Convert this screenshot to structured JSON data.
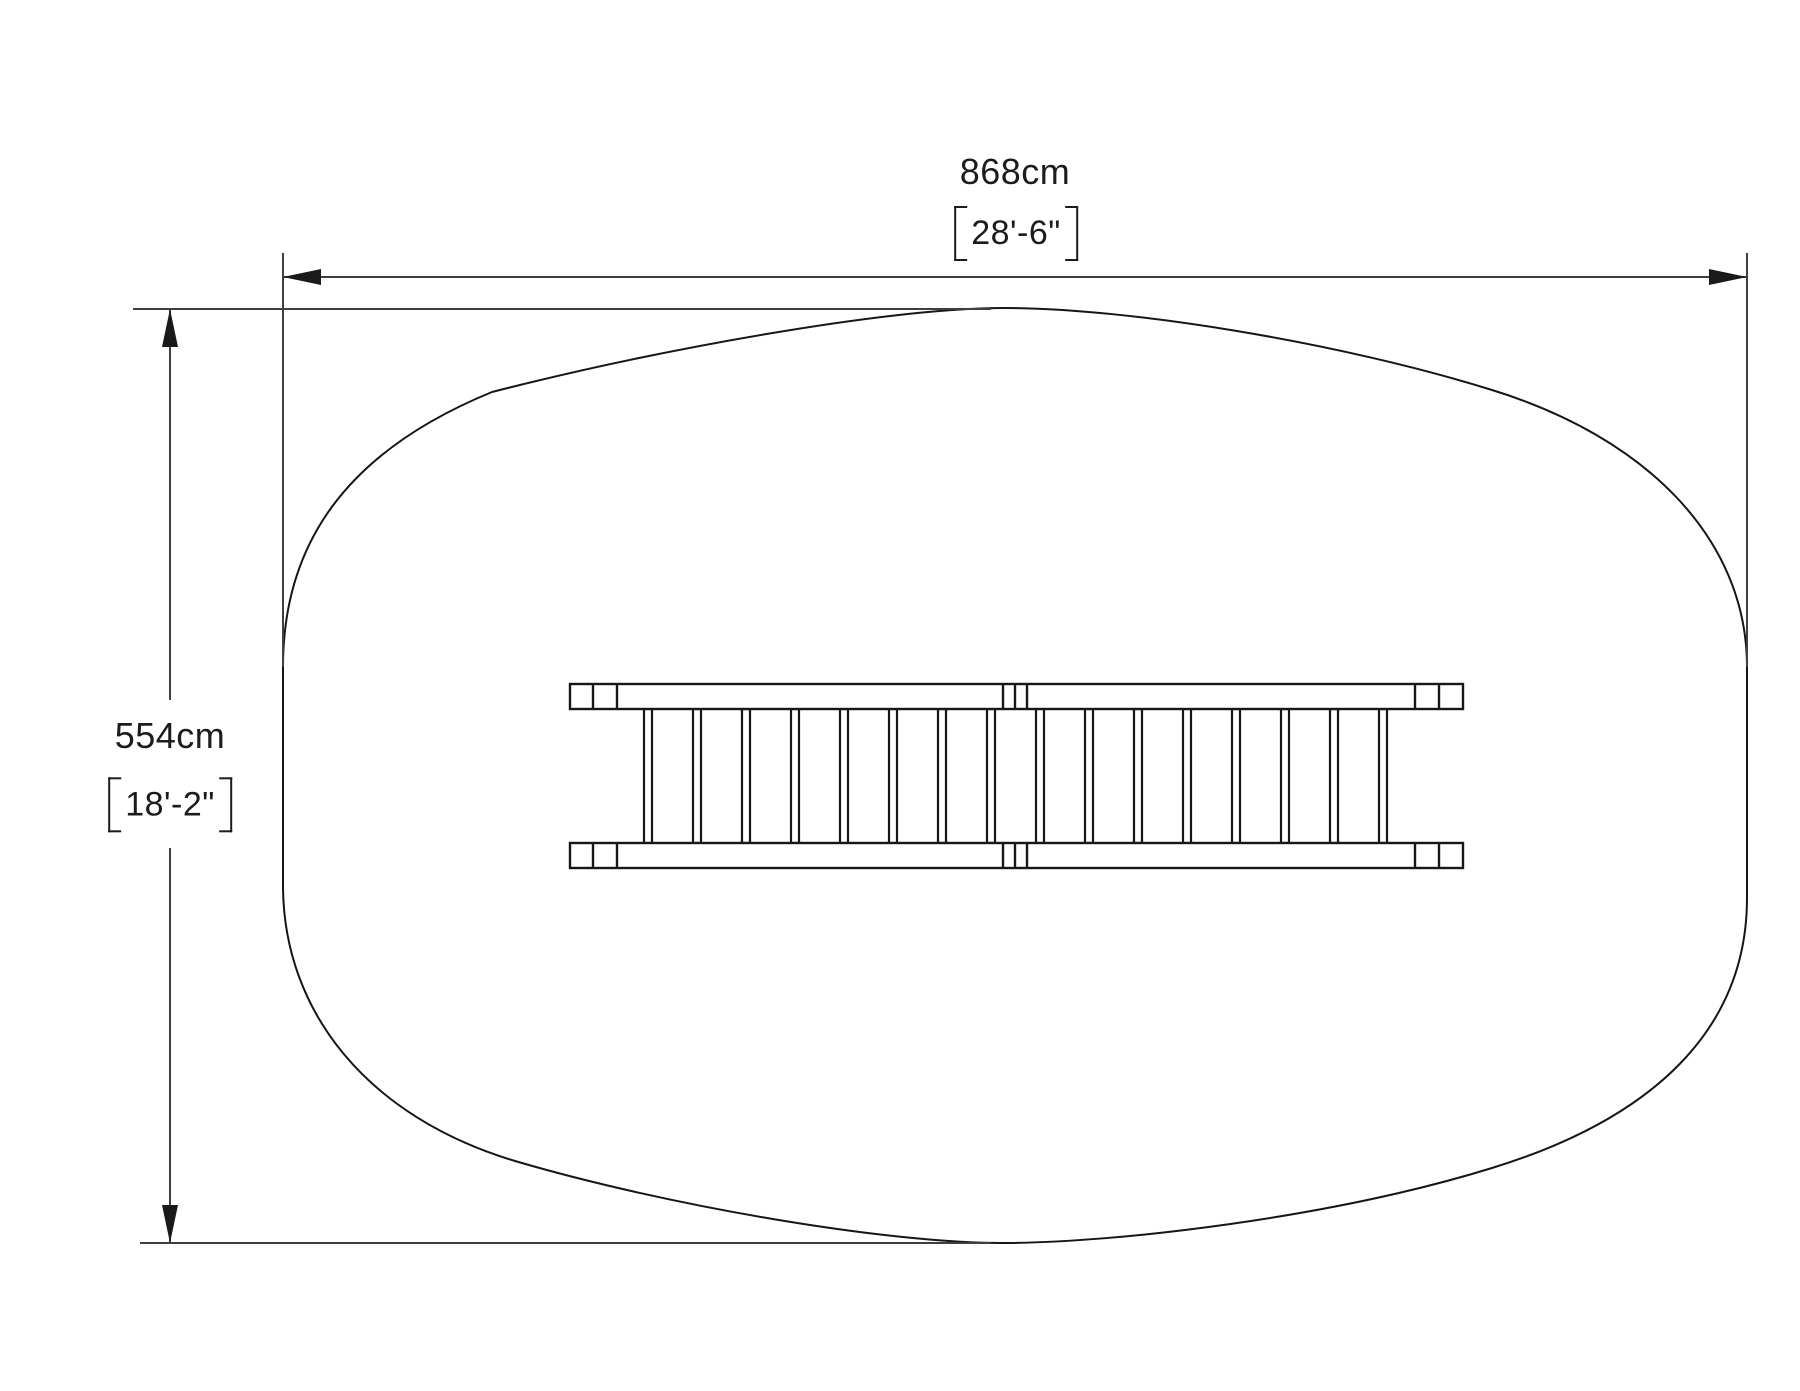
{
  "drawing": {
    "type": "plan-view-technical-drawing",
    "background_color": "#ffffff",
    "line_color": "#161616",
    "dimension_line_color": "#3f3f3f",
    "text_color": "#1c1c1c",
    "width_dimension": {
      "metric": "868cm",
      "imperial": "28'-6\""
    },
    "height_dimension": {
      "metric": "554cm",
      "imperial": "18'-2\""
    },
    "ladder": {
      "rung_count": 16,
      "divider_positions": [
        593,
        617,
        1003,
        1015,
        1027,
        1415,
        1439
      ]
    }
  }
}
